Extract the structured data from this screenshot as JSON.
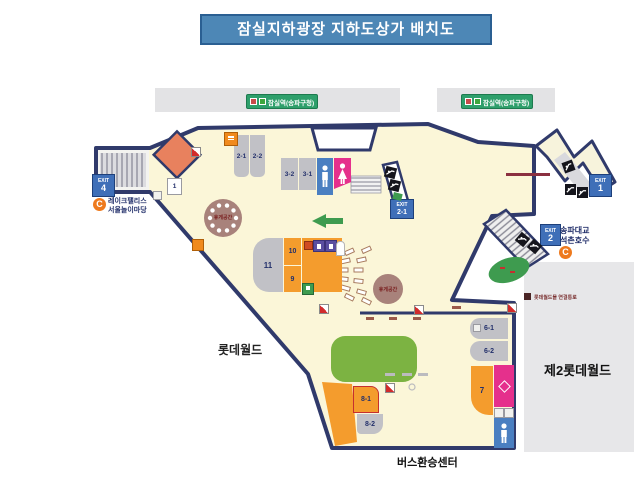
{
  "title": "잠실지하광장  지하도상가 배치도",
  "station_label": "잠실역(송파구청)",
  "exit_word": "EXIT",
  "exits": {
    "e4": "4",
    "e21": "2-1",
    "e1": "1",
    "e2": "2"
  },
  "blocks": {
    "b1": "1",
    "b2_1": "2-1",
    "b2_2": "2-2",
    "b3_2": "3-2",
    "b3_1": "3-1",
    "b6_1": "6-1",
    "b6_2": "6-2",
    "b7": "7",
    "b8_1": "8-1",
    "b8_2": "8-2",
    "b9": "9",
    "b10": "10",
    "b11": "11"
  },
  "labels": {
    "lake_palace_line1": "레이크팰리스",
    "lake_palace_line2": "서울놀이마당",
    "lotte_world": "롯데월드",
    "lotte_world_2": "제2롯데월드",
    "bus_center": "버스환승센터",
    "songpa_line1": "송파대교",
    "songpa_line2": "석촌호수",
    "passage": "롯데월드몰 연결통로",
    "rest_area_left": "휴게공간",
    "rest_area_right": "휴게공간",
    "c_mark": "C"
  },
  "colors": {
    "banner": "#4D87B6",
    "wall": "#303A6B",
    "floor": "#FBF6D8",
    "block_gray": "#C1C1C6",
    "block_orange": "#F49C2D",
    "restroom_blue": "#4A7FC1",
    "restroom_pink": "#E5308C",
    "green": "#3E9B4F",
    "station_green": "#2E9F6B",
    "exit_blue": "#3F6FB8",
    "circle_brown": "#A8827B"
  }
}
